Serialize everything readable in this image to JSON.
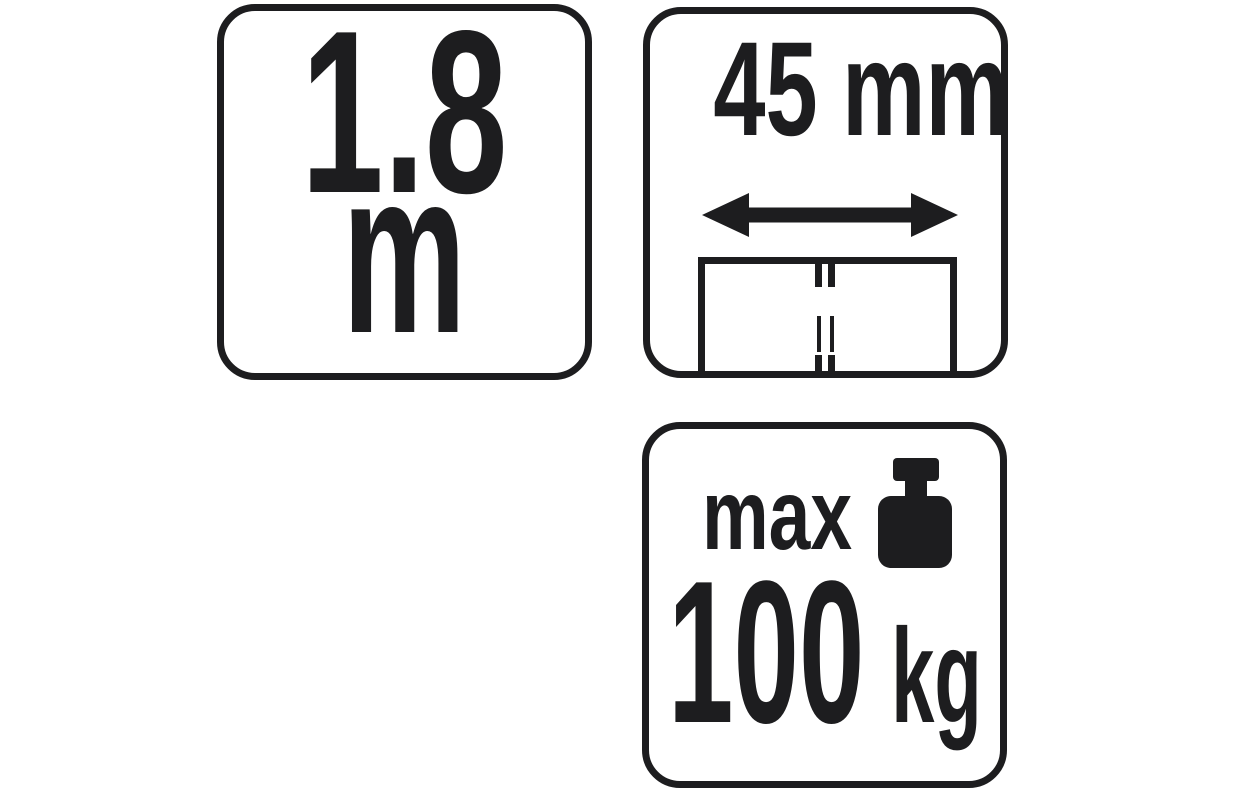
{
  "colors": {
    "ink": "#1d1d1f",
    "background": "#ffffff"
  },
  "badges": {
    "length": {
      "name": "rope length",
      "value": "1.8",
      "unit": "m"
    },
    "width": {
      "name": "strap width",
      "value": "45",
      "unit": "mm",
      "icons": [
        "double-arrow-icon",
        "strap-cross-section-icon"
      ]
    },
    "load": {
      "name": "maximum load",
      "prefix": "max",
      "value": "100",
      "unit": "kg",
      "icons": [
        "weight-icon"
      ]
    }
  }
}
